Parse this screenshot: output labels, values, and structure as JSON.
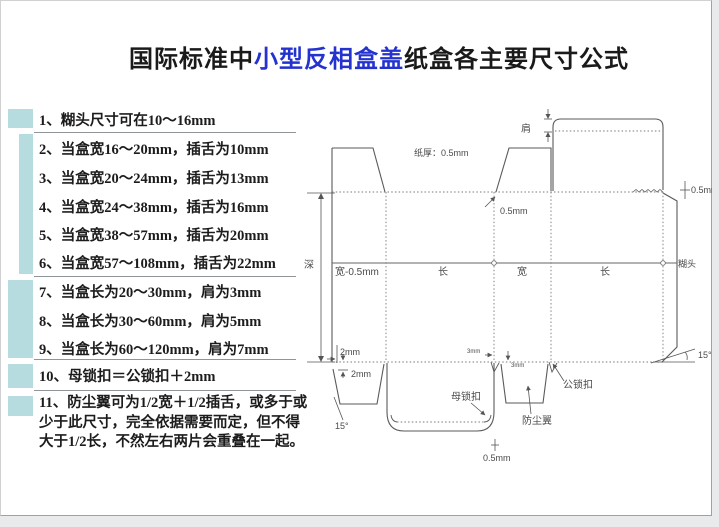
{
  "title": {
    "prefix": "国际标准中",
    "highlight": "小型反相盒盖",
    "suffix": "纸盒各主要尺寸公式"
  },
  "colors": {
    "title_highlight": "#2433cf",
    "group_marker": "#b7dce0",
    "line": "#5a5a5a"
  },
  "rules": {
    "items": [
      "1、糊头尺寸可在10～16mm",
      "2、当盒宽16～20mm，插舌为10mm",
      "3、当盒宽20～24mm，插舌为13mm",
      "4、当盒宽24～38mm，插舌为16mm",
      "5、当盒宽38～57mm，插舌为20mm",
      "6、当盒宽57～108mm，插舌为22mm",
      "7、当盒长为20～30mm，肩为3mm",
      "8、当盒长为30～60mm，肩为5mm",
      "9、当盒长为60～120mm，肩为7mm",
      "10、母锁扣＝公锁扣＋2mm",
      "11、防尘翼可为1/2宽＋1/2插舌，或多于或少于此尺寸，完全依据需要而定，但不得大于1/2长，不然左右两片会重叠在一起。"
    ]
  },
  "diagram": {
    "paper_thickness": "纸厚：0.5mm",
    "shoulder_label": "肩",
    "depth_label": "深",
    "panels": [
      "宽-0.5mm",
      "长",
      "宽",
      "长",
      "糊头"
    ],
    "dim_05_top": "0.5mm",
    "dim_05_right": "0.5mm",
    "dim_05_bottom": "0.5mm",
    "dim_2_a": "2mm",
    "dim_2_b": "2mm",
    "dim_3_a": "3mm",
    "dim_3_b": "3mm",
    "angle_right": "15°",
    "angle_left": "15°",
    "female_lock": "母锁扣",
    "male_lock": "公锁扣",
    "dust_wing": "防尘翼"
  }
}
